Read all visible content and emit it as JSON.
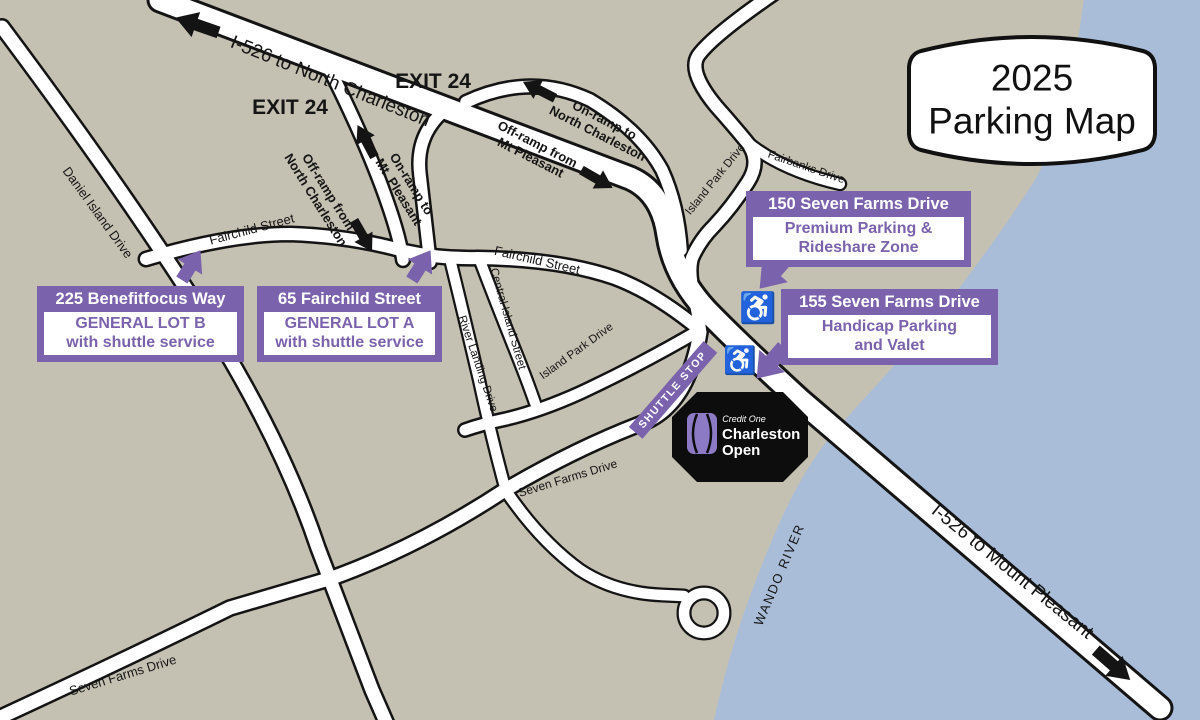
{
  "sign": {
    "year": "2025",
    "title": "Parking Map"
  },
  "highways": {
    "to_north_charleston": "I-526 to North Charleston",
    "to_mount_pleasant": "I-526 to Mount Pleasant"
  },
  "exits": {
    "left": "EXIT 24",
    "right": "EXIT 24"
  },
  "ramps": {
    "on_to_north_charleston": "On-ramp to\nNorth Charleston",
    "off_from_mt_pleasant": "Off-ramp from\nMt Pleasant",
    "off_from_north_charleston": "Off-ramp from\nNorth Charleston",
    "on_to_mt_pleasant": "On-ramp to\nMt. Pleasant"
  },
  "streets": {
    "daniel_island": "Daniel Island Drive",
    "fairchild": "Fairchild Street",
    "central_island": "Central Island Street",
    "river_landing": "River Landing Drive",
    "island_park": "Island Park Drive",
    "fairbanks": "Fairbanks Drive",
    "seven_farms": "Seven Farms Drive"
  },
  "water": {
    "label": "WANDO RIVER"
  },
  "shuttle_stop": {
    "label": "SHUTTLE STOP"
  },
  "parking": {
    "lot_b": {
      "address": "225 Benefitfocus Way",
      "line1": "GENERAL LOT B",
      "line2": "with shuttle service"
    },
    "lot_a": {
      "address": "65 Fairchild Street",
      "line1": "GENERAL LOT A",
      "line2": "with shuttle service"
    },
    "premium": {
      "address": "150 Seven Farms Drive",
      "line1": "Premium Parking &",
      "line2": "Rideshare Zone"
    },
    "handicap": {
      "address": "155 Seven Farms Drive",
      "line1": "Handicap Parking",
      "line2": "and Valet"
    }
  },
  "venue": {
    "brand": "Credit One",
    "name_line1": "Charleston",
    "name_line2": "Open"
  },
  "icons": {
    "wheelchair": "♿"
  },
  "colors": {
    "purple": "#7a63ac",
    "land": "#c5c1b2",
    "water": "#a9bdd9",
    "road": "#ffffff",
    "outline": "#141414",
    "handicap_blue": "#1e86c6",
    "logo_purple": "#8c7bc4"
  }
}
